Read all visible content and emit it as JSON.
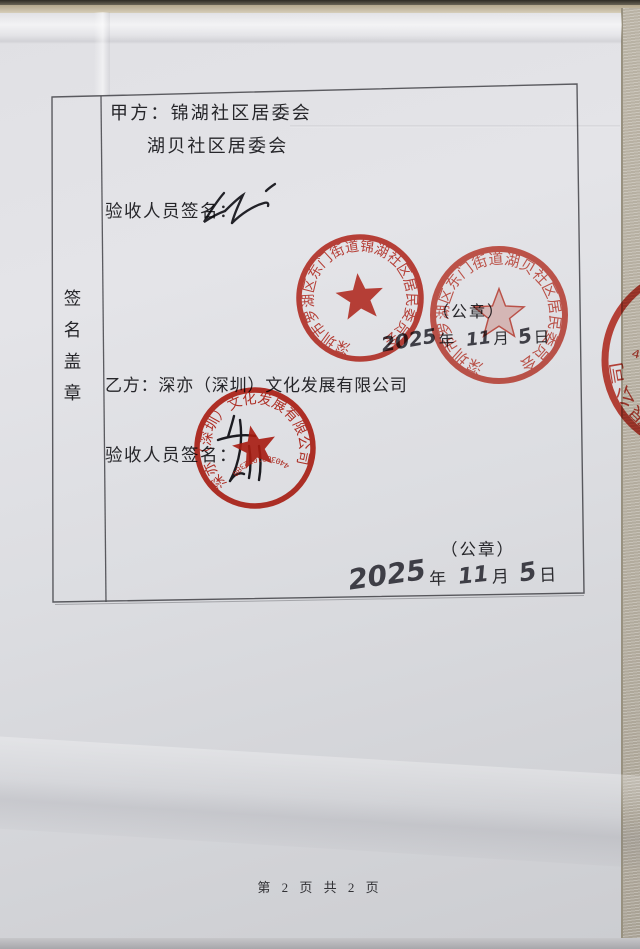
{
  "document": {
    "row_label": "签名盖章",
    "party_a": {
      "line1": "甲方：锦湖社区居委会",
      "line2": "湖贝社区居委会",
      "sign_label": "验收人员签名：",
      "seal_note": "（公章）",
      "date": {
        "year": "2025",
        "year_unit": "年",
        "month": "11",
        "month_unit": "月",
        "day": "5",
        "day_unit": "日"
      }
    },
    "party_b": {
      "line1": "乙方：深亦（深圳）文化发展有限公司",
      "sign_label": "验收人员签名：",
      "seal_note": "（公章）",
      "date": {
        "year": "2025",
        "year_unit": "年",
        "month": "11",
        "month_unit": "月",
        "day": "5",
        "day_unit": "日"
      }
    },
    "footer": "第 2 页 共 2 页",
    "seals": {
      "jinhu": {
        "ring_text": "深圳市罗湖区东门街道锦湖社区居民委员会"
      },
      "hubei": {
        "ring_text": "深圳市罗湖区东门街道湖贝社区居民委员会"
      },
      "company": {
        "ring_text": "深亦（深圳）文化发展有限公司",
        "number": "4403031012380"
      },
      "company_edge": {
        "ring_text": "深亦（深圳）文化发展有限公司",
        "number": "4403031012380"
      }
    },
    "colors": {
      "seal_red": "#c4261a",
      "seal_red_light": "#c93425",
      "ink": "#26262a"
    }
  }
}
